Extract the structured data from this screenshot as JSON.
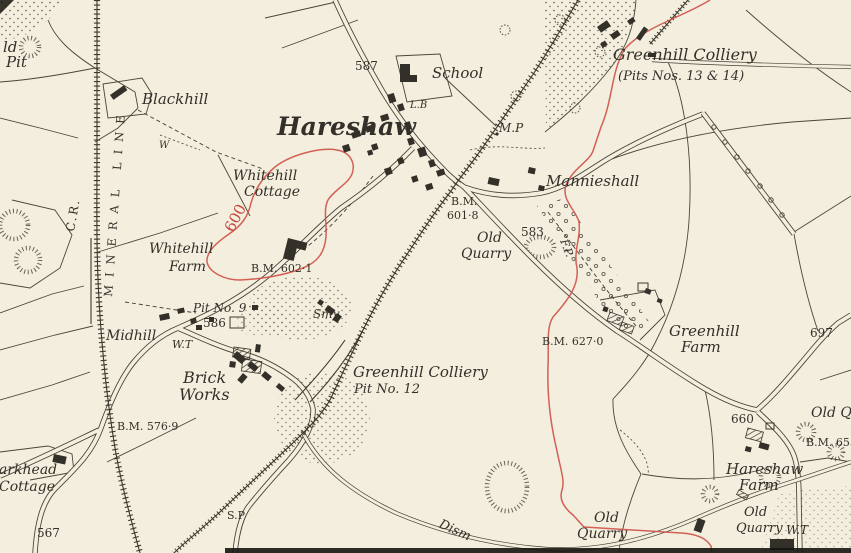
{
  "map": {
    "colors": {
      "paper": "#f3eedd",
      "ink": "#33302a",
      "red": "#c8473d"
    },
    "labels": [
      {
        "id": "old-pit-line1",
        "text": "ld",
        "x": 3,
        "y": 52,
        "size": 15,
        "rot": 0,
        "style": "italic",
        "color": "ink"
      },
      {
        "id": "old-pit-line2",
        "text": "Pit",
        "x": 6,
        "y": 67,
        "size": 15,
        "rot": 0,
        "style": "italic",
        "color": "ink"
      },
      {
        "id": "blackhill",
        "text": "Blackhill",
        "x": 142,
        "y": 104,
        "size": 15,
        "rot": 0,
        "style": "italic",
        "color": "ink"
      },
      {
        "id": "caledonian-railway",
        "text": "C.R.",
        "x": 74,
        "y": 232,
        "size": 12,
        "rot": -80,
        "style": "upright",
        "color": "ink",
        "ls": 2
      },
      {
        "id": "mineral-line",
        "text": "MINERAL LINE",
        "x": 112,
        "y": 297,
        "size": 11.5,
        "rot": -86,
        "style": "upright",
        "color": "ink",
        "ls": 8
      },
      {
        "id": "spot-height-587",
        "text": "587",
        "x": 355,
        "y": 70,
        "size": 12,
        "rot": 0,
        "style": "upright",
        "color": "ink"
      },
      {
        "id": "school",
        "text": "School",
        "x": 432,
        "y": 78,
        "size": 15,
        "rot": 0,
        "style": "italic",
        "color": "ink"
      },
      {
        "id": "letter-box",
        "text": "L.B",
        "x": 410,
        "y": 108,
        "size": 10,
        "rot": 0,
        "style": "italic",
        "color": "ink"
      },
      {
        "id": "hareshaw-village",
        "text": "Hareshaw",
        "x": 277,
        "y": 135,
        "size": 25,
        "rot": 0,
        "style": "italic",
        "color": "ink",
        "weight": "bold"
      },
      {
        "id": "mile-post",
        "text": "M.P",
        "x": 499,
        "y": 132,
        "size": 12,
        "rot": 0,
        "style": "italic",
        "color": "ink"
      },
      {
        "id": "greenhill-colliery-13-14",
        "text": "Greenhill Colliery",
        "x": 613,
        "y": 60,
        "size": 16,
        "rot": 0,
        "style": "italic",
        "color": "ink"
      },
      {
        "id": "greenhill-colliery-pits",
        "text": "(Pits Nos. 13 & 14)",
        "x": 618,
        "y": 80,
        "size": 13,
        "rot": 0,
        "style": "italic",
        "color": "ink"
      },
      {
        "id": "mannieshall",
        "text": "Mannieshall",
        "x": 546,
        "y": 186,
        "size": 15,
        "rot": 0,
        "style": "italic",
        "color": "ink"
      },
      {
        "id": "whitehill-cottage-1",
        "text": "Whitehill",
        "x": 233,
        "y": 180,
        "size": 14,
        "rot": 0,
        "style": "italic",
        "color": "ink"
      },
      {
        "id": "whitehill-cottage-2",
        "text": "Cottage",
        "x": 244,
        "y": 196,
        "size": 14,
        "rot": 0,
        "style": "italic",
        "color": "ink"
      },
      {
        "id": "contour-600",
        "text": "600",
        "x": 233,
        "y": 233,
        "size": 15,
        "rot": -62,
        "style": "upright",
        "color": "red"
      },
      {
        "id": "whitehill-farm-1",
        "text": "Whitehill",
        "x": 149,
        "y": 253,
        "size": 14,
        "rot": 0,
        "style": "italic",
        "color": "ink"
      },
      {
        "id": "whitehill-farm-2",
        "text": "Farm",
        "x": 169,
        "y": 271,
        "size": 14,
        "rot": 0,
        "style": "italic",
        "color": "ink"
      },
      {
        "id": "bm-602-1",
        "text": "B.M. 602·1",
        "x": 251,
        "y": 272,
        "size": 11,
        "rot": 0,
        "style": "upright",
        "color": "ink"
      },
      {
        "id": "pit-no-9",
        "text": "Pit No. 9",
        "x": 193,
        "y": 312,
        "size": 12,
        "rot": 0,
        "style": "italic",
        "color": "ink"
      },
      {
        "id": "spot-height-586",
        "text": "586",
        "x": 203,
        "y": 327,
        "size": 12,
        "rot": 0,
        "style": "upright",
        "color": "ink"
      },
      {
        "id": "smithy",
        "text": "Smy",
        "x": 313,
        "y": 318,
        "size": 12,
        "rot": 0,
        "style": "italic",
        "color": "ink"
      },
      {
        "id": "midhill",
        "text": "Midhill",
        "x": 106,
        "y": 340,
        "size": 14,
        "rot": 0,
        "style": "italic",
        "color": "ink"
      },
      {
        "id": "water-trough-midhill",
        "text": "W.T",
        "x": 172,
        "y": 348,
        "size": 11,
        "rot": 0,
        "style": "italic",
        "color": "ink"
      },
      {
        "id": "brick-works-1",
        "text": "Brick",
        "x": 183,
        "y": 383,
        "size": 16,
        "rot": 0,
        "style": "italic",
        "color": "ink"
      },
      {
        "id": "brick-works-2",
        "text": "Works",
        "x": 179,
        "y": 400,
        "size": 16,
        "rot": 0,
        "style": "italic",
        "color": "ink"
      },
      {
        "id": "bm-576-9",
        "text": "B.M. 576·9",
        "x": 117,
        "y": 430,
        "size": 11,
        "rot": 0,
        "style": "upright",
        "color": "ink"
      },
      {
        "id": "greenhill-colliery-12",
        "text": "Greenhill Colliery",
        "x": 353,
        "y": 377,
        "size": 15,
        "rot": 0,
        "style": "italic",
        "color": "ink"
      },
      {
        "id": "greenhill-colliery-12-pit",
        "text": "Pit No. 12",
        "x": 354,
        "y": 393,
        "size": 13,
        "rot": 0,
        "style": "italic",
        "color": "ink"
      },
      {
        "id": "signal-post",
        "text": "S.P",
        "x": 227,
        "y": 519,
        "size": 11,
        "rot": 0,
        "style": "upright",
        "color": "ink"
      },
      {
        "id": "parkhead-cottage-1",
        "text": "arkhead",
        "x": -1,
        "y": 474,
        "size": 14,
        "rot": 0,
        "style": "italic",
        "color": "ink"
      },
      {
        "id": "parkhead-cottage-2",
        "text": "Cottage",
        "x": -1,
        "y": 491,
        "size": 14,
        "rot": 0,
        "style": "italic",
        "color": "ink"
      },
      {
        "id": "spot-height-567",
        "text": "567",
        "x": 37,
        "y": 537,
        "size": 12,
        "rot": 0,
        "style": "upright",
        "color": "ink"
      },
      {
        "id": "bm-601-8-a",
        "text": "B.M.",
        "x": 451,
        "y": 205,
        "size": 11,
        "rot": 0,
        "style": "upright",
        "color": "ink"
      },
      {
        "id": "bm-601-8-b",
        "text": "601·8",
        "x": 447,
        "y": 219,
        "size": 11,
        "rot": 0,
        "style": "upright",
        "color": "ink"
      },
      {
        "id": "old-quarry-center-1",
        "text": "Old",
        "x": 477,
        "y": 242,
        "size": 14,
        "rot": 0,
        "style": "italic",
        "color": "ink"
      },
      {
        "id": "old-quarry-center-2",
        "text": "Quarry",
        "x": 461,
        "y": 258,
        "size": 14,
        "rot": 0,
        "style": "italic",
        "color": "ink"
      },
      {
        "id": "spot-height-583",
        "text": "583",
        "x": 521,
        "y": 236,
        "size": 12,
        "rot": 0,
        "style": "upright",
        "color": "ink"
      },
      {
        "id": "footpath",
        "text": "F.P.",
        "x": 560,
        "y": 241,
        "size": 11,
        "rot": 68,
        "style": "italic",
        "color": "ink"
      },
      {
        "id": "bm-627-0",
        "text": "B.M. 627·0",
        "x": 542,
        "y": 345,
        "size": 11,
        "rot": 0,
        "style": "upright",
        "color": "ink"
      },
      {
        "id": "greenhill-farm-1",
        "text": "Greenhill",
        "x": 669,
        "y": 336,
        "size": 15,
        "rot": 0,
        "style": "italic",
        "color": "ink"
      },
      {
        "id": "greenhill-farm-2",
        "text": "Farm",
        "x": 681,
        "y": 352,
        "size": 15,
        "rot": 0,
        "style": "italic",
        "color": "ink"
      },
      {
        "id": "spot-height-697",
        "text": "697",
        "x": 810,
        "y": 337,
        "size": 12,
        "rot": 0,
        "style": "upright",
        "color": "ink"
      },
      {
        "id": "spot-height-660",
        "text": "660",
        "x": 731,
        "y": 423,
        "size": 12,
        "rot": 0,
        "style": "upright",
        "color": "ink"
      },
      {
        "id": "old-quarry-edge",
        "text": "Old Q",
        "x": 811,
        "y": 417,
        "size": 14,
        "rot": 0,
        "style": "italic",
        "color": "ink"
      },
      {
        "id": "bm-655",
        "text": "B.M. 655",
        "x": 806,
        "y": 446,
        "size": 11,
        "rot": 0,
        "style": "upright",
        "color": "ink"
      },
      {
        "id": "hareshaw-farm-1",
        "text": "Hareshaw",
        "x": 726,
        "y": 474,
        "size": 15,
        "rot": 0,
        "style": "italic",
        "color": "ink"
      },
      {
        "id": "hareshaw-farm-2",
        "text": "Farm",
        "x": 739,
        "y": 490,
        "size": 15,
        "rot": 0,
        "style": "italic",
        "color": "ink"
      },
      {
        "id": "old-quarry-south-1",
        "text": "Old",
        "x": 594,
        "y": 522,
        "size": 14,
        "rot": 0,
        "style": "italic",
        "color": "ink"
      },
      {
        "id": "old-quarry-south-2",
        "text": "Quarry",
        "x": 577,
        "y": 538,
        "size": 14,
        "rot": 0,
        "style": "italic",
        "color": "ink"
      },
      {
        "id": "old-quarry-farm-1",
        "text": "Old",
        "x": 744,
        "y": 516,
        "size": 13,
        "rot": 0,
        "style": "italic",
        "color": "ink"
      },
      {
        "id": "old-quarry-farm-2",
        "text": "Quarry",
        "x": 736,
        "y": 532,
        "size": 13,
        "rot": 0,
        "style": "italic",
        "color": "ink"
      },
      {
        "id": "water-trough-farm",
        "text": "W.T",
        "x": 786,
        "y": 534,
        "size": 12,
        "rot": 0,
        "style": "italic",
        "color": "ink"
      },
      {
        "id": "dismantled",
        "text": "Dism",
        "x": 438,
        "y": 527,
        "size": 13,
        "rot": 24,
        "style": "italic",
        "color": "ink"
      },
      {
        "id": "well",
        "text": "W",
        "x": 159,
        "y": 148,
        "size": 10,
        "rot": 0,
        "style": "italic",
        "color": "ink"
      }
    ]
  }
}
